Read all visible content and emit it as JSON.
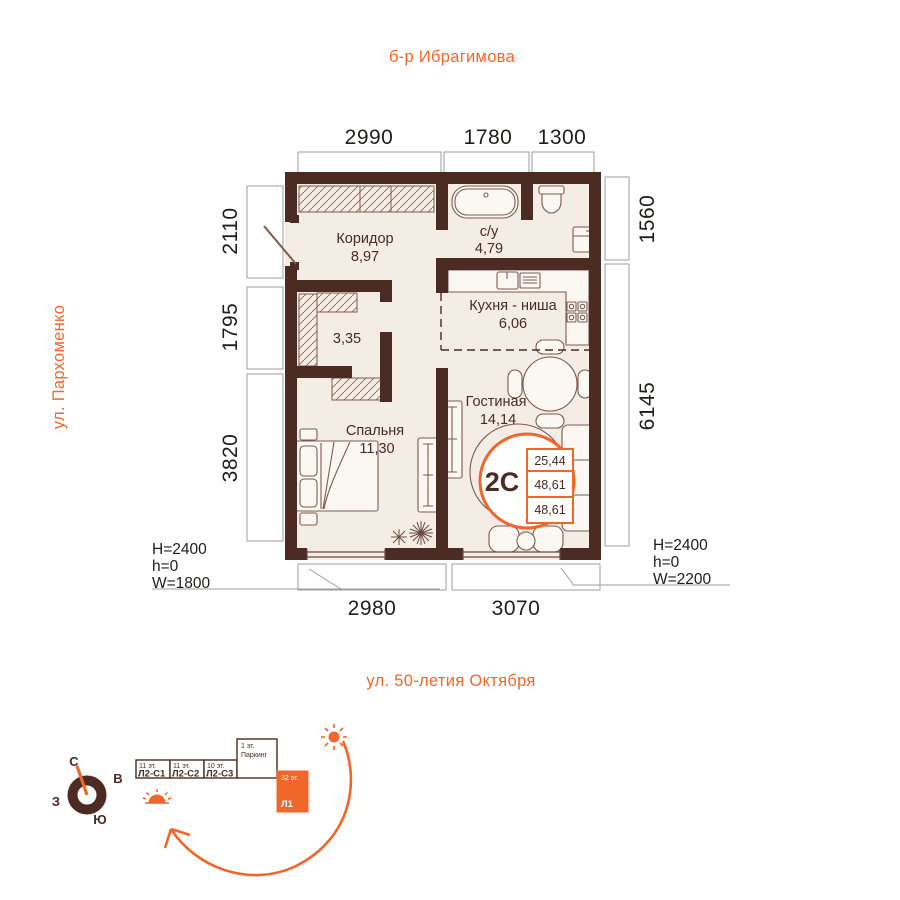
{
  "streets": {
    "top": "б-р Ибрагимова",
    "left": "ул. Пархоменко",
    "bottom": "ул. 50-летия Октября"
  },
  "dimensions": {
    "top": [
      "2990",
      "1780",
      "1300"
    ],
    "left": [
      "2110",
      "1795",
      "3820"
    ],
    "right": [
      "1560",
      "6145"
    ],
    "bottom": [
      "2980",
      "3070"
    ]
  },
  "window_specs": {
    "left": [
      "H=2400",
      "h=0",
      "W=1800"
    ],
    "right": [
      "H=2400",
      "h=0",
      "W=2200"
    ]
  },
  "rooms": {
    "hallway": {
      "name": "Коридор",
      "area": "8,97"
    },
    "bathroom": {
      "name": "с/у",
      "area": "4,79"
    },
    "kitchen": {
      "name": "Кухня - ниша",
      "area": "6,06"
    },
    "living": {
      "name": "Гостиная",
      "area": "14,14"
    },
    "bedroom": {
      "name": "Спальня",
      "area": "11,30"
    },
    "closet": {
      "area": "3,35"
    }
  },
  "unit_badge": {
    "type": "2С",
    "values": [
      "25,44",
      "48,61",
      "48,61"
    ]
  },
  "compass": {
    "n": "С",
    "e": "В",
    "s": "Ю",
    "w": "З"
  },
  "minimap": {
    "blocks": [
      {
        "floors": "11 эт.",
        "name": "Л2-С1"
      },
      {
        "floors": "11 эт.",
        "name": "Л2-С2"
      },
      {
        "floors": "10 эт.",
        "name": "Л2-С3"
      },
      {
        "floors": "1 эт.",
        "name": "Паркинг"
      },
      {
        "floors": "32 эт.",
        "name": "Л1"
      }
    ]
  },
  "colors": {
    "accent": "#f0662b",
    "wall": "#4b2b22"
  }
}
